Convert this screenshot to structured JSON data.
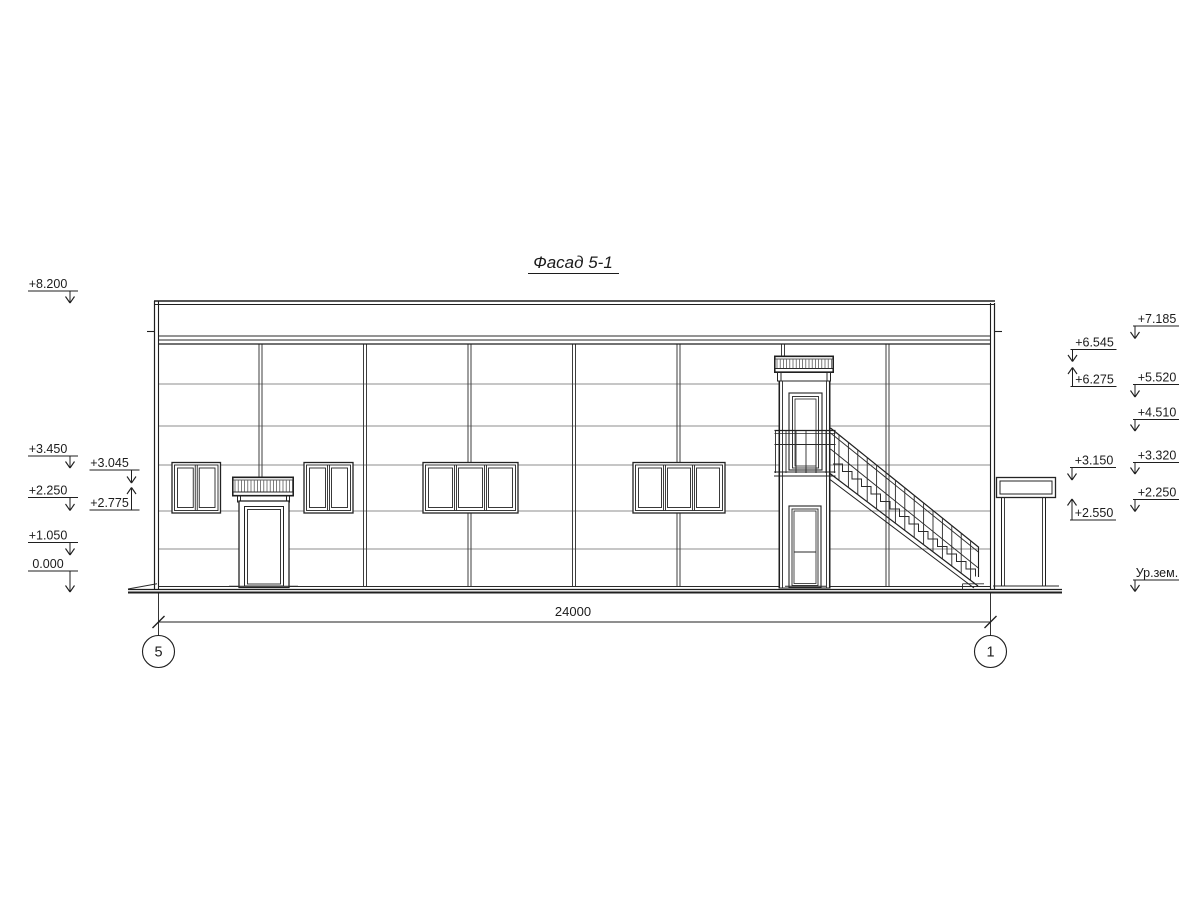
{
  "title": "Фасад 5-1",
  "dimension": {
    "total_label": "24000"
  },
  "axes": {
    "left_label": "5",
    "right_label": "1"
  },
  "elevation_marks": {
    "left_outer": [
      {
        "label": "+8.200",
        "dir": "down"
      },
      {
        "label": "+3.450",
        "dir": "down"
      },
      {
        "label": "+2.250",
        "dir": "down"
      },
      {
        "label": "+1.050",
        "dir": "down"
      },
      {
        "label": "0.000",
        "dir": "down"
      }
    ],
    "left_inner": [
      {
        "label": "+3.045",
        "dir": "down"
      },
      {
        "label": "+2.775",
        "dir": "up"
      }
    ],
    "right_inner": [
      {
        "label": "+6.545",
        "dir": "down"
      },
      {
        "label": "+6.275",
        "dir": "up"
      },
      {
        "label": "+3.150",
        "dir": "down"
      },
      {
        "label": "+2.550",
        "dir": "up"
      }
    ],
    "right_outer": [
      {
        "label": "+7.185",
        "dir": "down"
      },
      {
        "label": "+5.520",
        "dir": "down"
      },
      {
        "label": "+4.510",
        "dir": "down"
      },
      {
        "label": "+3.320",
        "dir": "down"
      },
      {
        "label": "+2.250",
        "dir": "down"
      },
      {
        "label": "Ур.зем.",
        "dir": "down"
      }
    ]
  },
  "colors": {
    "background": "#ffffff",
    "main_line": "#1f1f1f",
    "panel_line": "#8c8c8c",
    "mullion_line": "#3d3d3d",
    "hatch_line": "#444444"
  }
}
